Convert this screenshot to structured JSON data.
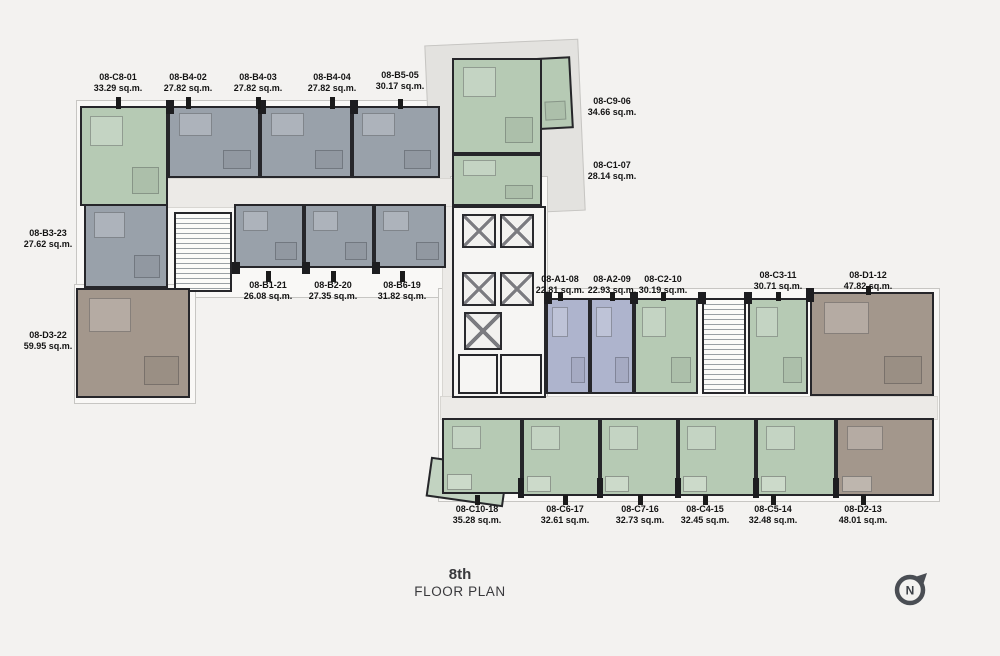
{
  "floor_title": {
    "floor": "8th",
    "label": "FLOOR PLAN"
  },
  "compass": {
    "label": "N"
  },
  "palette": {
    "unit_green": "#b6cab4",
    "unit_gray": "#99a1aa",
    "unit_blue": "#aeb4cd",
    "unit_brown": "#a3978c",
    "corridor": "#eceae7",
    "wall": "#26262a",
    "background": "#f3f2f0"
  },
  "units": [
    {
      "name": "08-C8-01",
      "area": "33.29 sq.m."
    },
    {
      "name": "08-B4-02",
      "area": "27.82 sq.m."
    },
    {
      "name": "08-B4-03",
      "area": "27.82 sq.m."
    },
    {
      "name": "08-B4-04",
      "area": "27.82 sq.m."
    },
    {
      "name": "08-B5-05",
      "area": "30.17 sq.m."
    },
    {
      "name": "08-C9-06",
      "area": "34.66 sq.m."
    },
    {
      "name": "08-C1-07",
      "area": "28.14 sq.m."
    },
    {
      "name": "08-B3-23",
      "area": "27.62 sq.m."
    },
    {
      "name": "08-D3-22",
      "area": "59.95 sq.m."
    },
    {
      "name": "08-B1-21",
      "area": "26.08 sq.m."
    },
    {
      "name": "08-B2-20",
      "area": "27.35 sq.m."
    },
    {
      "name": "08-B6-19",
      "area": "31.82 sq.m."
    },
    {
      "name": "08-A1-08",
      "area": "22.81 sq.m."
    },
    {
      "name": "08-A2-09",
      "area": "22.93 sq.m."
    },
    {
      "name": "08-C2-10",
      "area": "30.19 sq.m."
    },
    {
      "name": "08-C3-11",
      "area": "30.71 sq.m."
    },
    {
      "name": "08-D1-12",
      "area": "47.82 sq.m."
    },
    {
      "name": "08-C10-18",
      "area": "35.28 sq.m."
    },
    {
      "name": "08-C6-17",
      "area": "32.61 sq.m."
    },
    {
      "name": "08-C7-16",
      "area": "32.73 sq.m."
    },
    {
      "name": "08-C4-15",
      "area": "32.45 sq.m."
    },
    {
      "name": "08-C5-14",
      "area": "32.48 sq.m."
    },
    {
      "name": "08-D2-13",
      "area": "48.01 sq.m."
    }
  ]
}
